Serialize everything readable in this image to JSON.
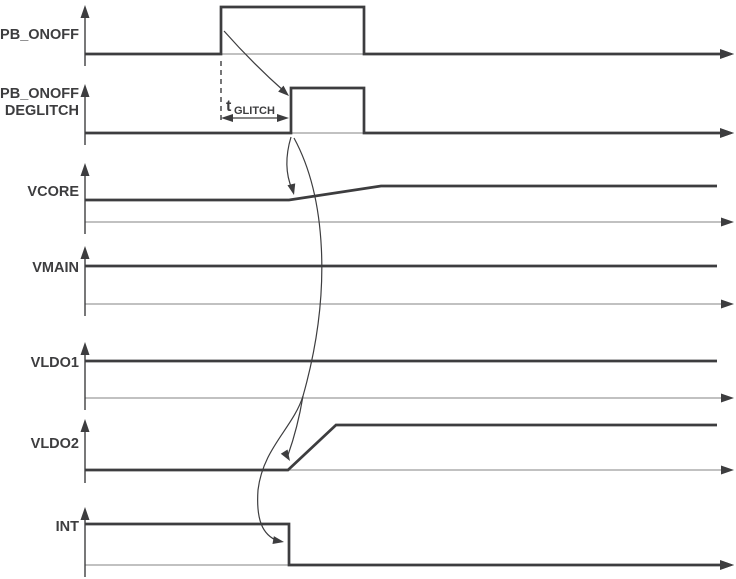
{
  "diagram": {
    "type": "timing-diagram",
    "background": "#ffffff",
    "colors": {
      "signal": "#3d3d3f",
      "axis": "#9c9c9c"
    },
    "rows": [
      {
        "label": "PB_ONOFF"
      },
      {
        "label": "PB_ONOFF",
        "label_line2": "DEGLITCH"
      },
      {
        "label": "VCORE"
      },
      {
        "label": "VMAIN"
      },
      {
        "label": "VLDO1"
      },
      {
        "label": "VLDO2"
      },
      {
        "label": "INT"
      }
    ],
    "annotations": {
      "t_glitch": {
        "symbol": "t",
        "subscript": "GLITCH"
      }
    }
  }
}
